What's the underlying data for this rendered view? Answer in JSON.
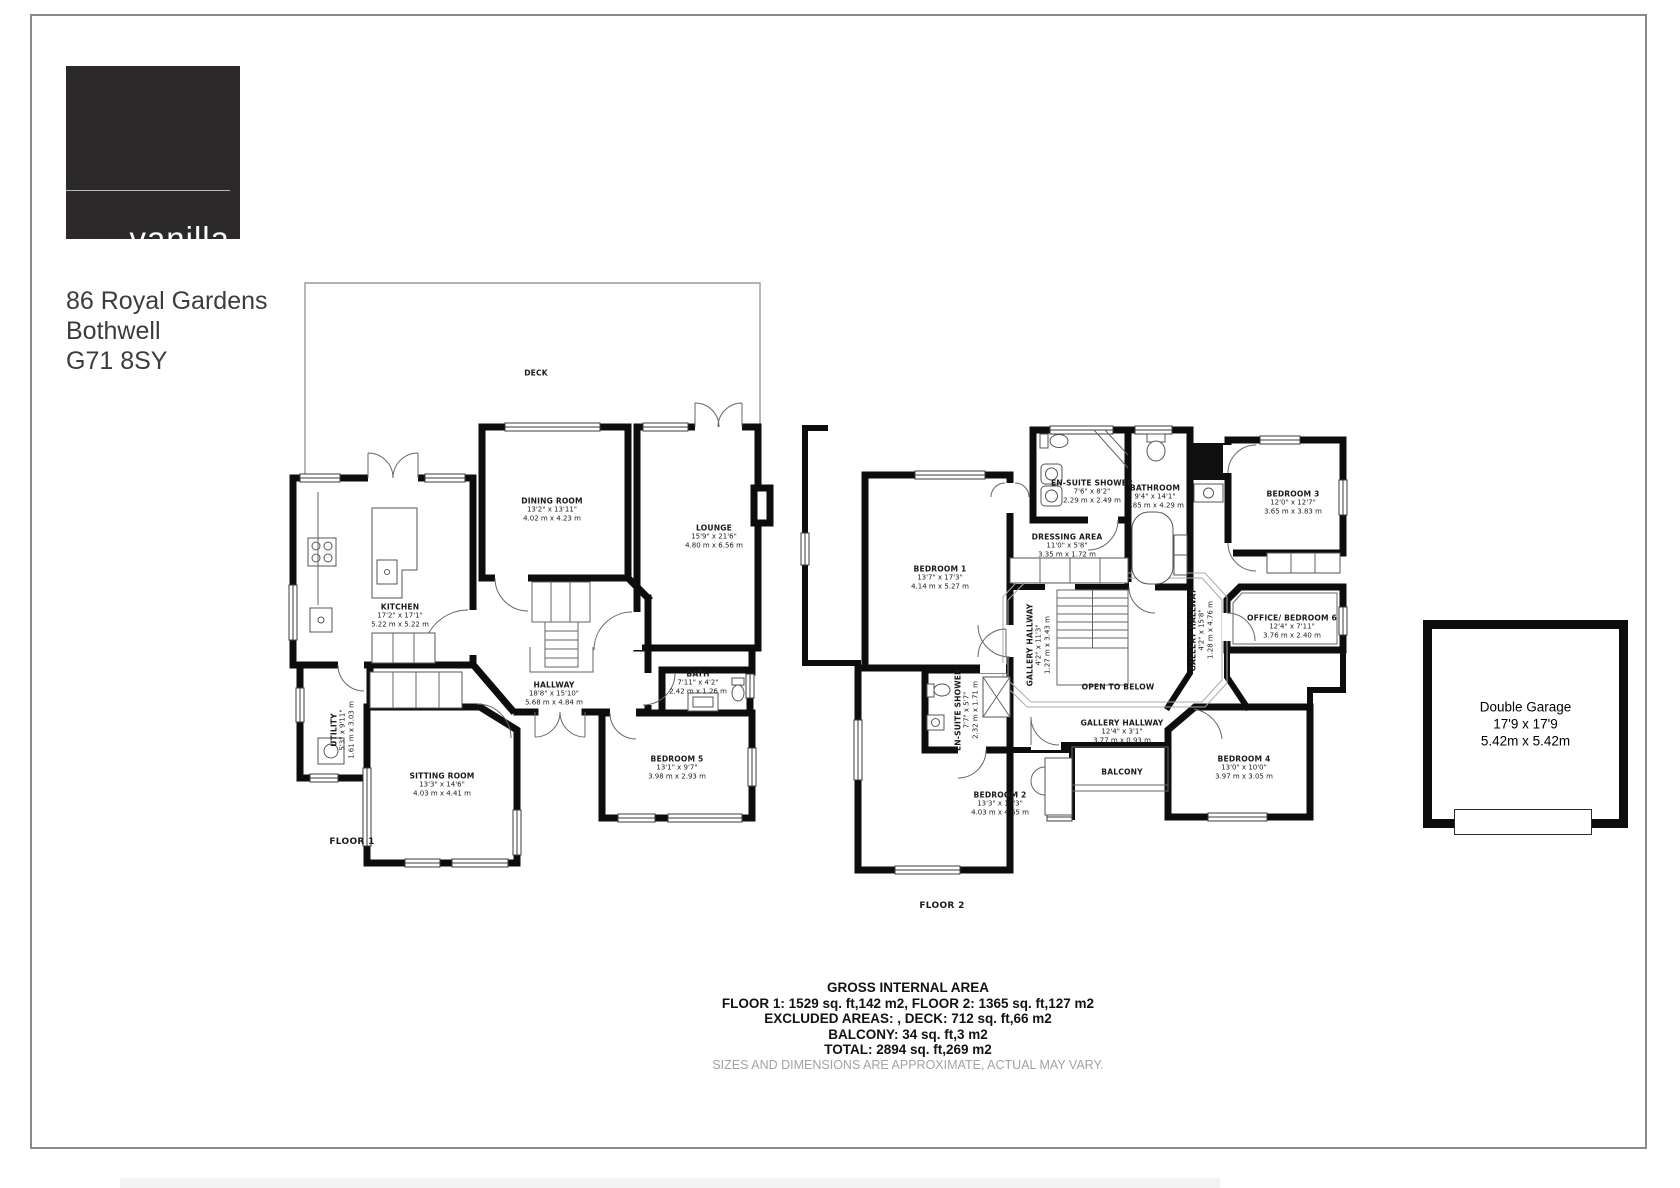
{
  "logo": {
    "brand_line1": "vanilla",
    "brand_line2": "square"
  },
  "address": {
    "line1": "86 Royal Gardens",
    "line2": "Bothwell",
    "line3": "G71 8SY"
  },
  "floor1": {
    "label": "FLOOR 1",
    "deck": {
      "name": "DECK"
    },
    "dining": {
      "name": "DINING ROOM",
      "imperial": "13'2\" x 13'11\"",
      "metric": "4.02 m x 4.23 m"
    },
    "lounge": {
      "name": "LOUNGE",
      "imperial": "15'9\" x 21'6\"",
      "metric": "4.80 m x 6.56 m"
    },
    "kitchen": {
      "name": "KITCHEN",
      "imperial": "17'2\" x 17'1\"",
      "metric": "5.22 m x 5.22 m"
    },
    "utility": {
      "name": "UTILITY",
      "imperial": "5'3\" x 9'11\"",
      "metric": "1.61 m x 3.03 m"
    },
    "sitting": {
      "name": "SITTING ROOM",
      "imperial": "13'3\" x 14'6\"",
      "metric": "4.03 m x 4.41 m"
    },
    "hallway": {
      "name": "HALLWAY",
      "imperial": "18'8\" x 15'10\"",
      "metric": "5.68 m x 4.84 m"
    },
    "bath": {
      "name": "BATH",
      "imperial": "7'11\" x 4'2\"",
      "metric": "2.42 m x 1.26 m"
    },
    "bedroom5": {
      "name": "BEDROOM 5",
      "imperial": "13'1\" x 9'7\"",
      "metric": "3.98 m x 2.93 m"
    }
  },
  "floor2": {
    "label": "FLOOR 2",
    "bedroom1": {
      "name": "BEDROOM 1",
      "imperial": "13'7\" x 17'3\"",
      "metric": "4.14 m x 5.27 m"
    },
    "ensuite1": {
      "name": "EN-SUITE SHOWER",
      "imperial": "7'6\" x 8'2\"",
      "metric": "2.29 m x 2.49 m"
    },
    "dressing": {
      "name": "DRESSING AREA",
      "imperial": "11'0\" x 5'8\"",
      "metric": "3.35 m x 1.72 m"
    },
    "bathroom": {
      "name": "BATHROOM",
      "imperial": "9'4\" x 14'1\"",
      "metric": "2.85 m x 4.29 m"
    },
    "bedroom3": {
      "name": "BEDROOM 3",
      "imperial": "12'0\" x 12'7\"",
      "metric": "3.65 m x 3.83 m"
    },
    "office": {
      "name": "OFFICE/ BEDROOM 6",
      "imperial": "12'4\" x 7'11\"",
      "metric": "3.76 m x 2.40 m"
    },
    "gallery_left": {
      "name": "GALLERY HALLWAY",
      "imperial": "4'2\" x 11'3\"",
      "metric": "1.27 m x 3.43 m"
    },
    "gallery_right": {
      "name": "GALLERY HALLWAY",
      "imperial": "4'2\" x 15'8\"",
      "metric": "1.28 m x 4.76 m"
    },
    "gallery_main": {
      "name": "GALLERY HALLWAY",
      "imperial": "12'4\" x 3'1\"",
      "metric": "3.77 m x 0.93 m"
    },
    "open_below": {
      "name": "OPEN TO BELOW"
    },
    "balcony": {
      "name": "BALCONY"
    },
    "ensuite2": {
      "name": "EN-SUITE SHOWER",
      "imperial": "7'7\" x 5'7\"",
      "metric": "2.32 m x 1.71 m"
    },
    "bedroom2": {
      "name": "BEDROOM 2",
      "imperial": "13'3\" x 15'3\"",
      "metric": "4.03 m x 4.65 m"
    },
    "bedroom4": {
      "name": "BEDROOM 4",
      "imperial": "13'0\" x 10'0\"",
      "metric": "3.97 m x 3.05 m"
    }
  },
  "garage": {
    "name": "Double Garage",
    "imperial": "17'9 x 17'9",
    "metric": "5.42m x 5.42m"
  },
  "areas": {
    "title": "GROSS INTERNAL AREA",
    "line1": "FLOOR 1: 1529 sq. ft,142 m2, FLOOR 2: 1365 sq. ft,127 m2",
    "line2": "EXCLUDED AREAS: , DECK: 712 sq. ft,66 m2",
    "line3": "BALCONY: 34 sq. ft,3 m2",
    "line4": "TOTAL: 2894 sq. ft,269 m2",
    "disclaimer": "SIZES AND DIMENSIONS ARE APPROXIMATE, ACTUAL MAY VARY."
  }
}
